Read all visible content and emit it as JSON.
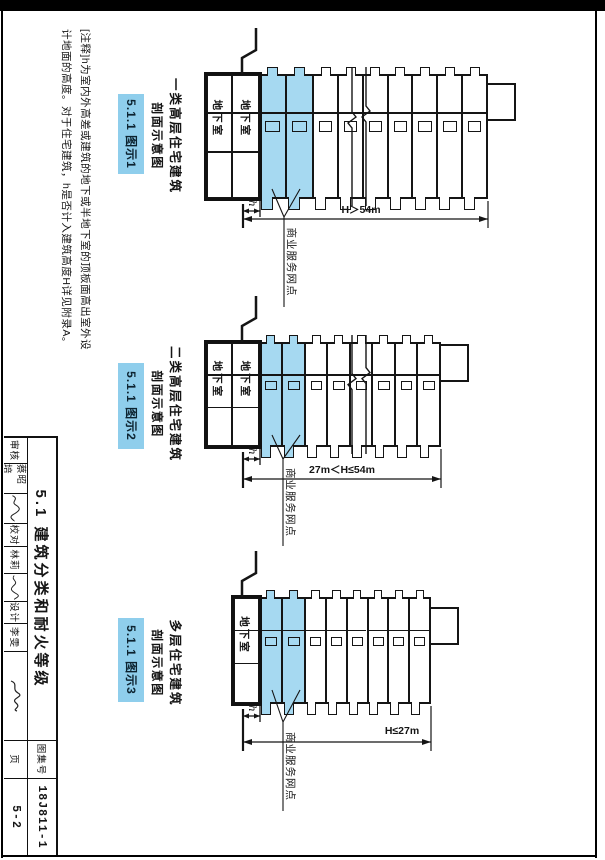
{
  "page": {
    "note_lines": [
      "[注释]h为室内外高差或建筑的地下或半地下室的顶板面高出室外设",
      "计地面的高度。对于住宅建筑，h是否计入建筑高度H详见附录A。"
    ],
    "title_block": {
      "title": "5.1 建筑分类和耐火等级",
      "fields": [
        {
          "label": "审核",
          "name": "蔡昭培"
        },
        {
          "label": "校对",
          "name": "林莉"
        },
        {
          "label": "设计",
          "name": "李雯"
        }
      ],
      "atlas_label": "图集号",
      "atlas_number": "18J811-1",
      "page_label": "页",
      "page_number": "5-2"
    },
    "colors": {
      "highlight": "#a6d9f1",
      "figure_box": "#8fceec"
    }
  },
  "diagrams": [
    {
      "id": "1",
      "title": "一类高层住宅建筑",
      "subtitle": "剖面示意图",
      "figure_label": "5.1.1 图示1",
      "height_dimension": "H＞54m",
      "h_label": "h",
      "basement_label": "地下室",
      "shop_label": "商业服务网点"
    },
    {
      "id": "2",
      "title": "二类高层住宅建筑",
      "subtitle": "剖面示意图",
      "figure_label": "5.1.1 图示2",
      "height_dimension": "27m＜H≤54m",
      "h_label": "h",
      "basement_label": "地下室",
      "shop_label": "商业服务网点"
    },
    {
      "id": "3",
      "title": "多层住宅建筑",
      "subtitle": "剖面示意图",
      "figure_label": "5.1.1 图示3",
      "height_dimension": "H≤27m",
      "h_label": "h",
      "basement_label": "地下室",
      "shop_label": "商业服务网点"
    }
  ]
}
